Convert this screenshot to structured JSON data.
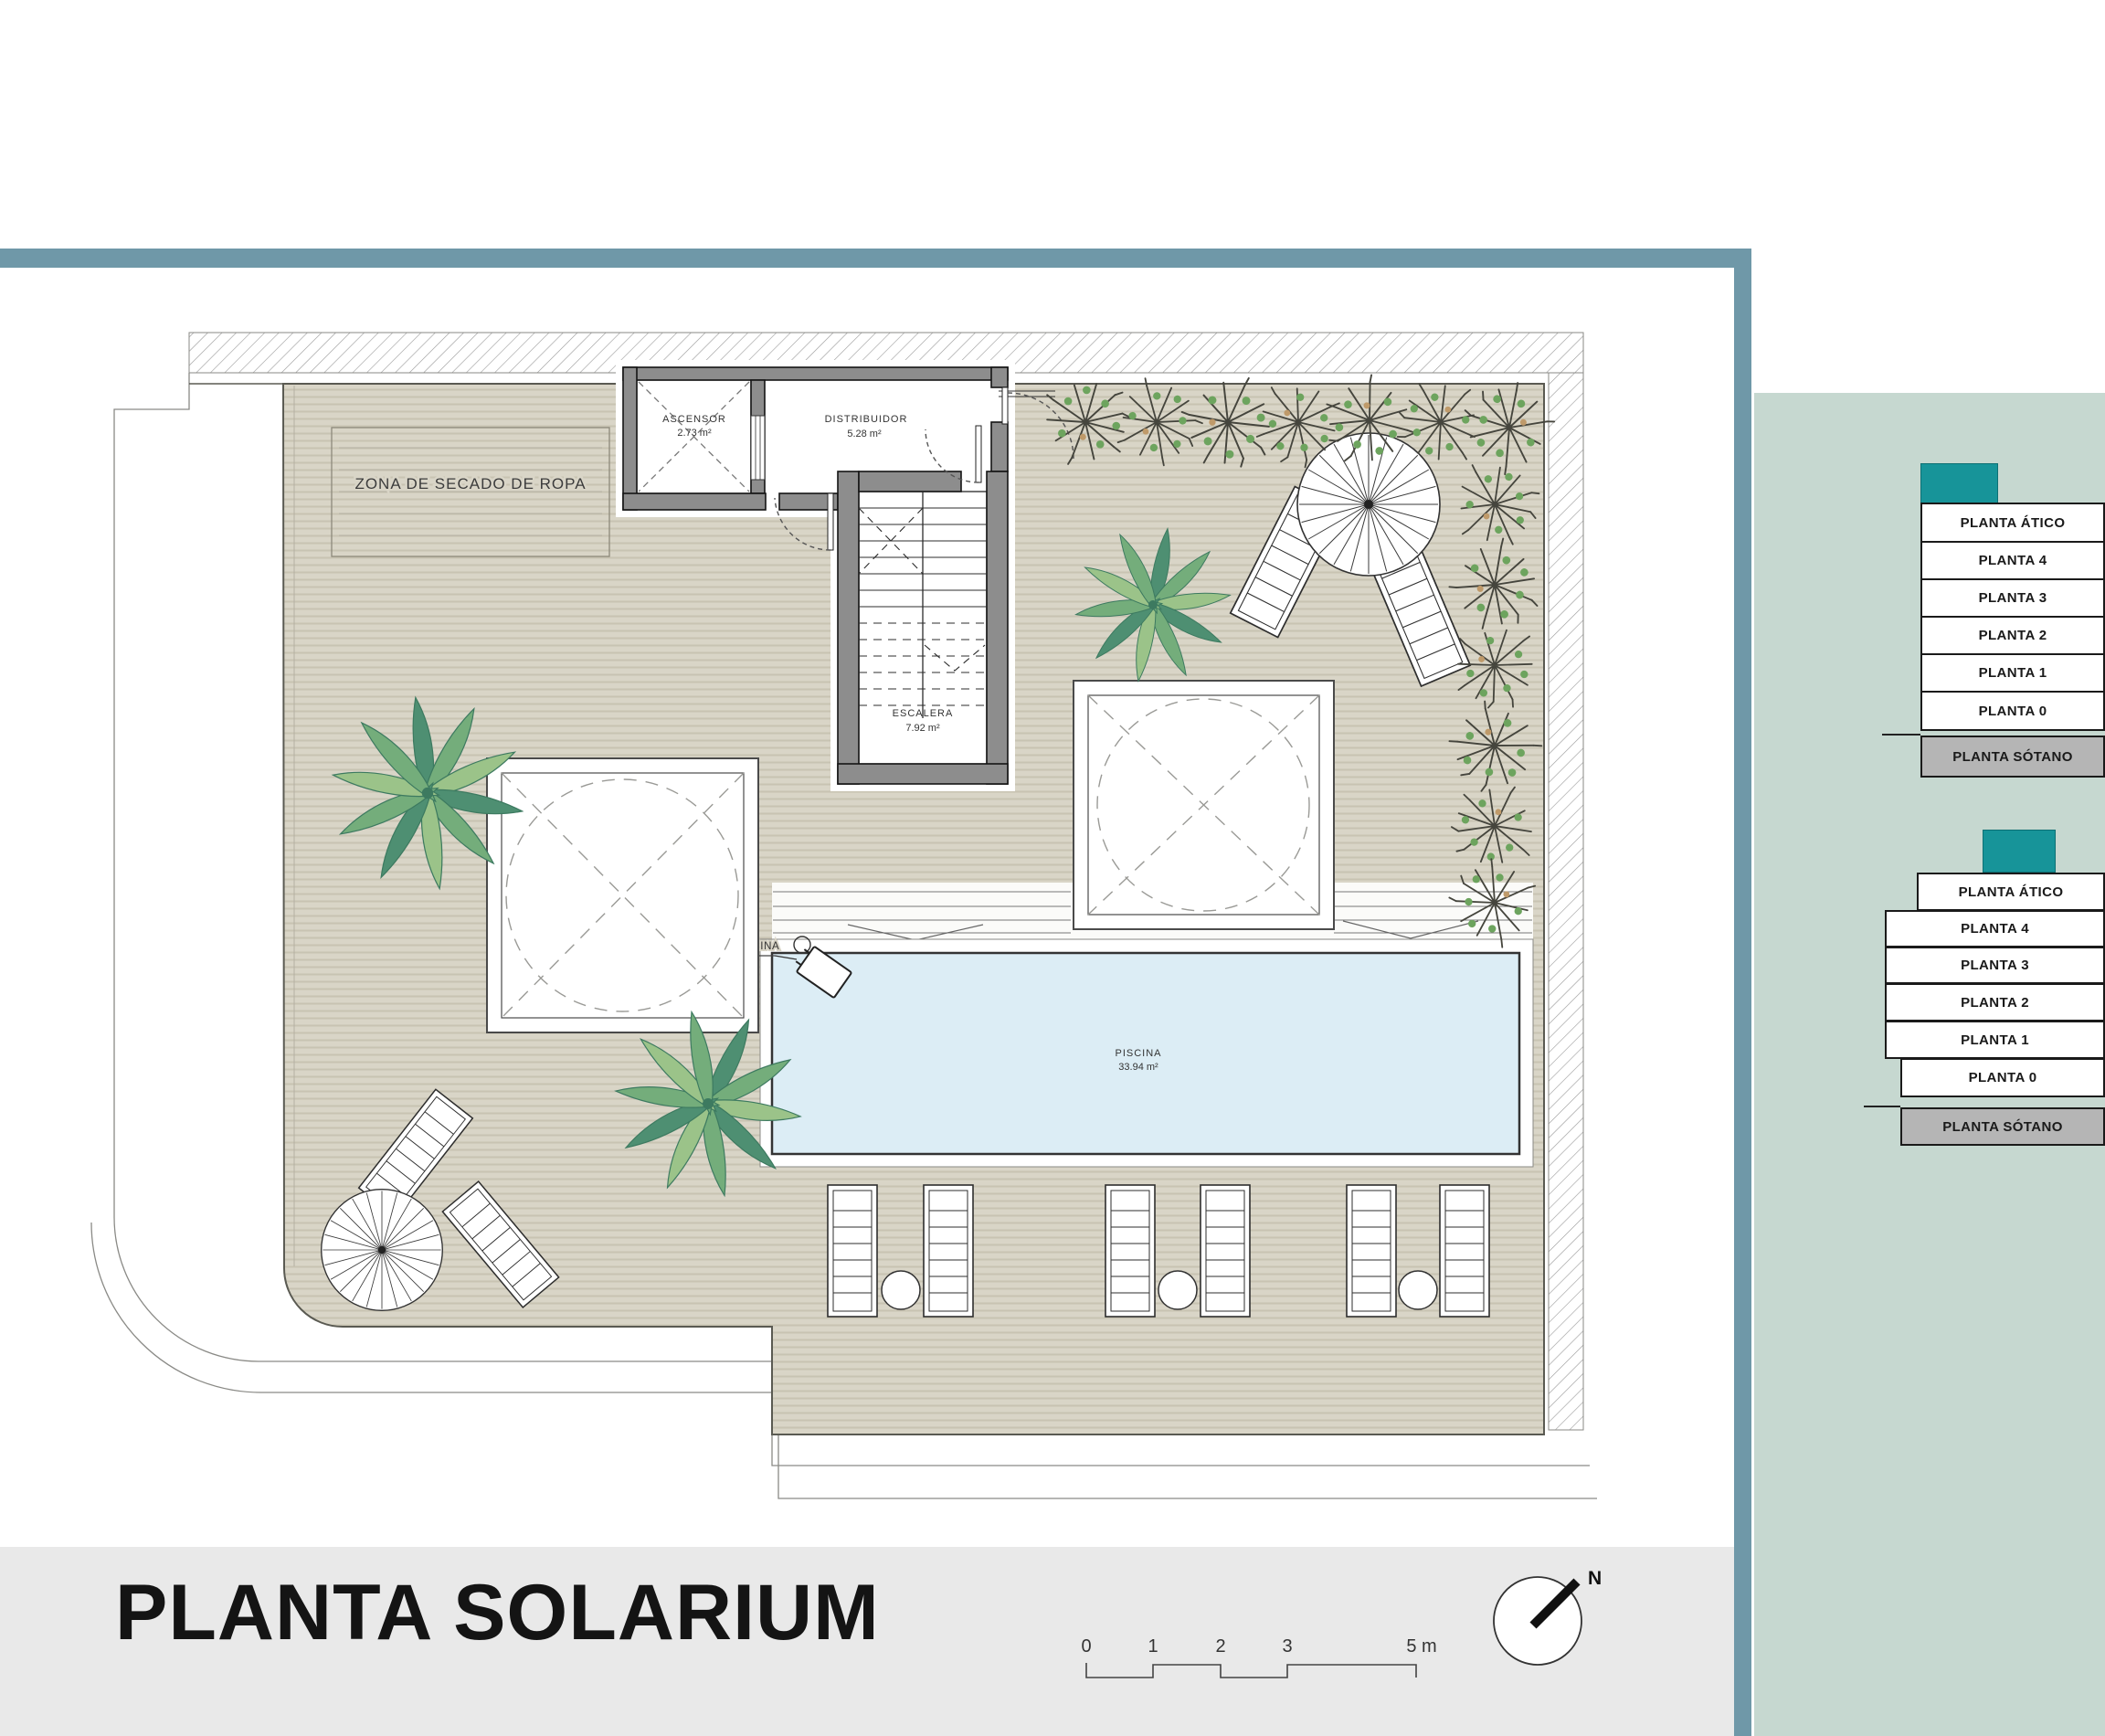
{
  "plan": {
    "rooms": {
      "ascensor": {
        "name": "ASCENSOR",
        "area": "2.73 m²"
      },
      "distribuidor": {
        "name": "DISTRIBUIDOR",
        "area": "5.28 m²"
      },
      "escalera": {
        "name": "ESCALERA",
        "area": "7.92 m²"
      },
      "piscina": {
        "name": "PISCINA",
        "area": "33.94 m²"
      }
    },
    "labels": {
      "drying_zone": "ZONA DE SECADO DE ROPA",
      "pool_crane": "GRÚA ELEVABLE DE PISCINA"
    }
  },
  "sidebar": {
    "stack1": {
      "levels": [
        "PLANTA ÁTICO",
        "PLANTA 4",
        "PLANTA 3",
        "PLANTA 2",
        "PLANTA 1",
        "PLANTA 0",
        "PLANTA SÓTANO"
      ]
    },
    "stack2": {
      "levels": [
        "PLANTA ÁTICO",
        "PLANTA 4",
        "PLANTA 3",
        "PLANTA 2",
        "PLANTA 1",
        "PLANTA 0",
        "PLANTA SÓTANO"
      ]
    }
  },
  "footer": {
    "title": "PLANTA SOLARIUM",
    "scale_ticks": [
      "0",
      "1",
      "2",
      "3",
      "5 m"
    ],
    "north_label": "N"
  },
  "colors": {
    "accent_teal": "#179499",
    "frame_teal": "#6f98a8",
    "sidebar_green": "#c6d8d0",
    "deck_beige": "#d9d5c7",
    "pool_blue": "#dcedf5",
    "footer_gray": "#e9e9e9",
    "wall_gray": "#8d8d8d",
    "basement_gray": "#b5b5b5"
  }
}
